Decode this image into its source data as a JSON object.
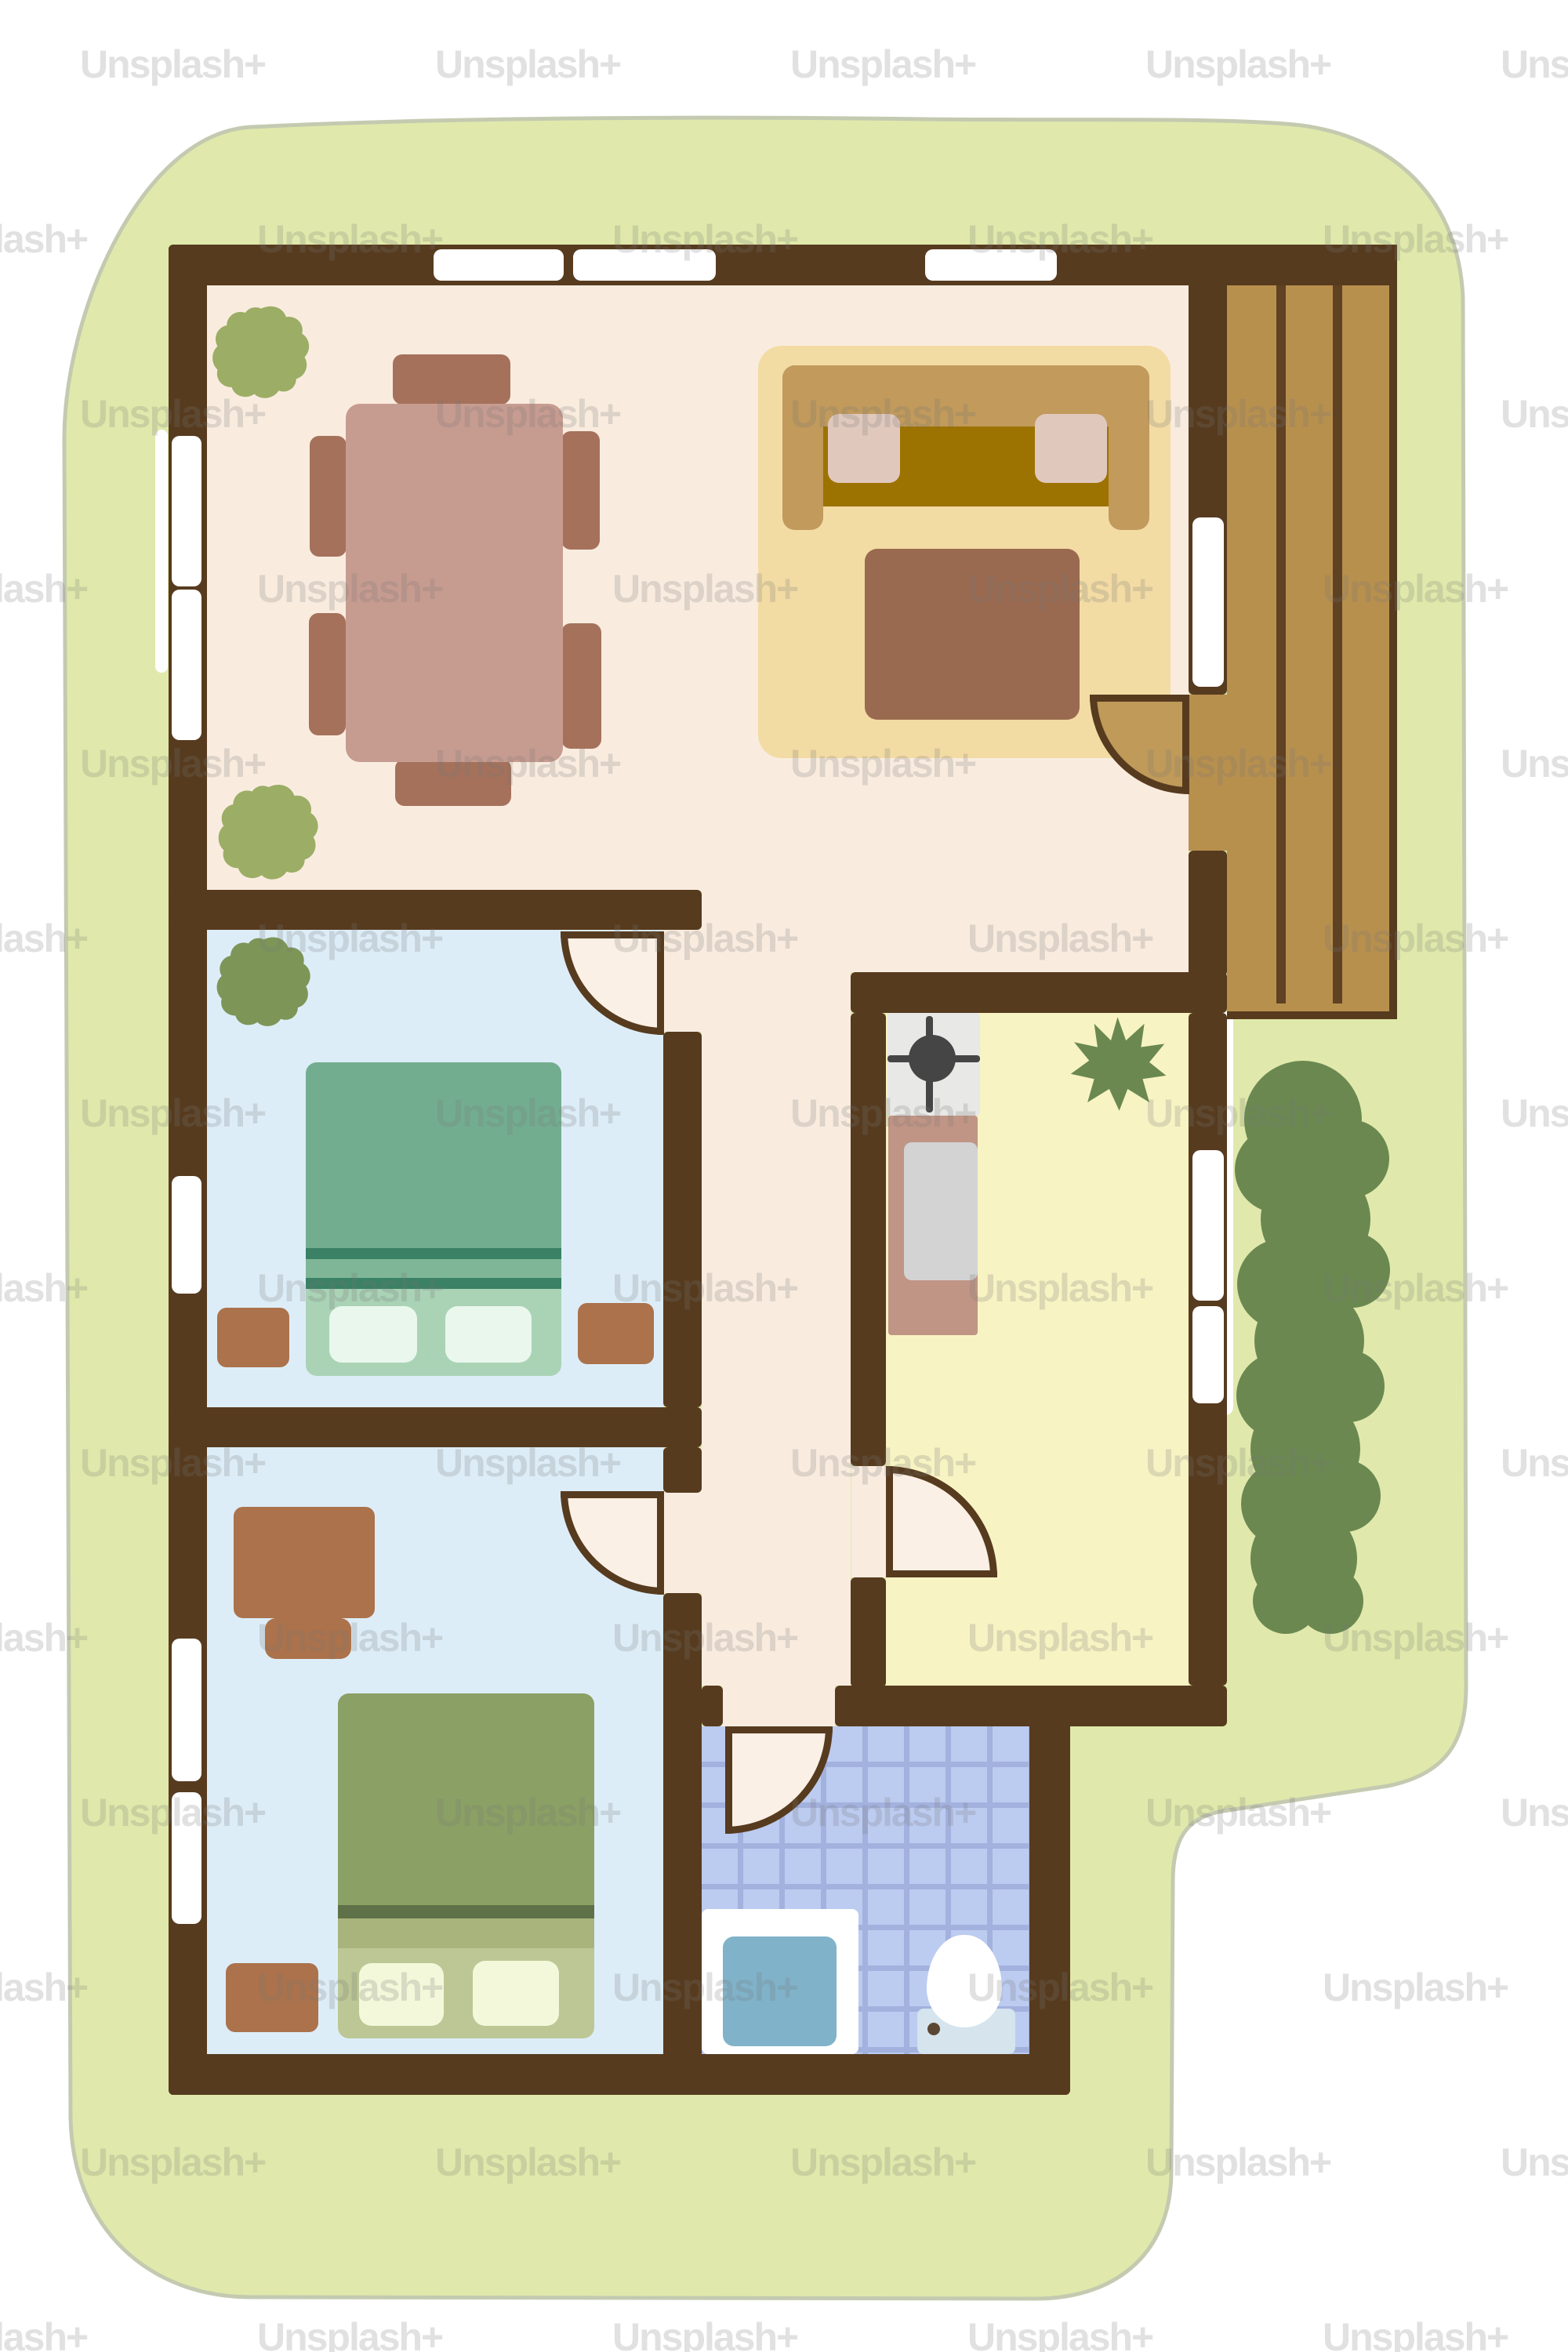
{
  "scene": {
    "kind": "hand-drawn house floor plan illustration, top view, on green lawn"
  },
  "watermark": {
    "label": "Unsplash+"
  },
  "palette": {
    "wall": "#573b1f",
    "floorCream": "#f9ecdf",
    "doorCream": "#fbf0e5",
    "floorBlue": "#ddedf8",
    "floorYellow": "#f8f3c3",
    "tile": "#bccbf0",
    "tileLine": "#a3b1de",
    "yard": "#e0e9ab",
    "yardStroke": "#c4cab0",
    "hedge": "#6b8851",
    "plantLight": "#9cad65",
    "plantMid": "#7d9557",
    "deck": "#b8904e",
    "doorTan": "#bf9a58",
    "window": "#ffffff",
    "rug": "#f3dba4",
    "sofaFrame": "#c19a5c",
    "sofaSeat": "#9c7200",
    "cushion": "#e0c8bd",
    "tvTable": "#996a50",
    "diningTable": "#c79c90",
    "chair": "#a5715b",
    "bed1Main": "#73ad8f",
    "bed1Stripe": "#3a8165",
    "bed1Band": "#7fb697",
    "bed1Lower": "#aad3b6",
    "bed1Pillow": "#eaf7ec",
    "bed2Main": "#8ba064",
    "bed2Stripe": "#5e7148",
    "bed2Band": "#a9b47d",
    "bed2Lower": "#bcc795",
    "bed2Pillow": "#f4f8da",
    "woodItem": "#ab724b",
    "stove": "#e8e8e6",
    "burner": "#454545",
    "counter": "#c09585",
    "counterInset": "#d3d3d3",
    "sinkWhite": "#ffffff",
    "basin": "#80b3c9",
    "tank": "#d5e4ed",
    "tankButton": "#5a4632",
    "toiletWhite": "#ffffff",
    "watermark": "rgba(120,120,120,0.22)"
  },
  "rooms": [
    {
      "name": "living-dining-room",
      "floor": "cream",
      "furniture": [
        "dining table",
        "six chairs",
        "two plants",
        "rug",
        "sofa",
        "two cushions",
        "tv unit"
      ]
    },
    {
      "name": "bedroom-1",
      "floor": "light-blue",
      "furniture": [
        "double bed",
        "two pillows",
        "two nightstands",
        "plant"
      ]
    },
    {
      "name": "bedroom-2",
      "floor": "light-blue",
      "furniture": [
        "double bed",
        "two pillows",
        "nightstand",
        "desk",
        "desk chair"
      ]
    },
    {
      "name": "kitchen",
      "floor": "pale-yellow",
      "furniture": [
        "stove",
        "counter with sink",
        "plant"
      ]
    },
    {
      "name": "bathroom",
      "floor": "blue-tile",
      "furniture": [
        "sink with basin",
        "toilet"
      ]
    },
    {
      "name": "hallway",
      "floor": "cream",
      "furniture": []
    },
    {
      "name": "deck",
      "floor": "wood-planks",
      "furniture": []
    },
    {
      "name": "yard",
      "floor": "grass",
      "features": [
        "lawn",
        "hedge"
      ]
    }
  ],
  "doors": [
    "bedroom-1-door",
    "bedroom-2-door",
    "kitchen-door",
    "bathroom-door",
    "deck-door"
  ],
  "windows_count": 11
}
